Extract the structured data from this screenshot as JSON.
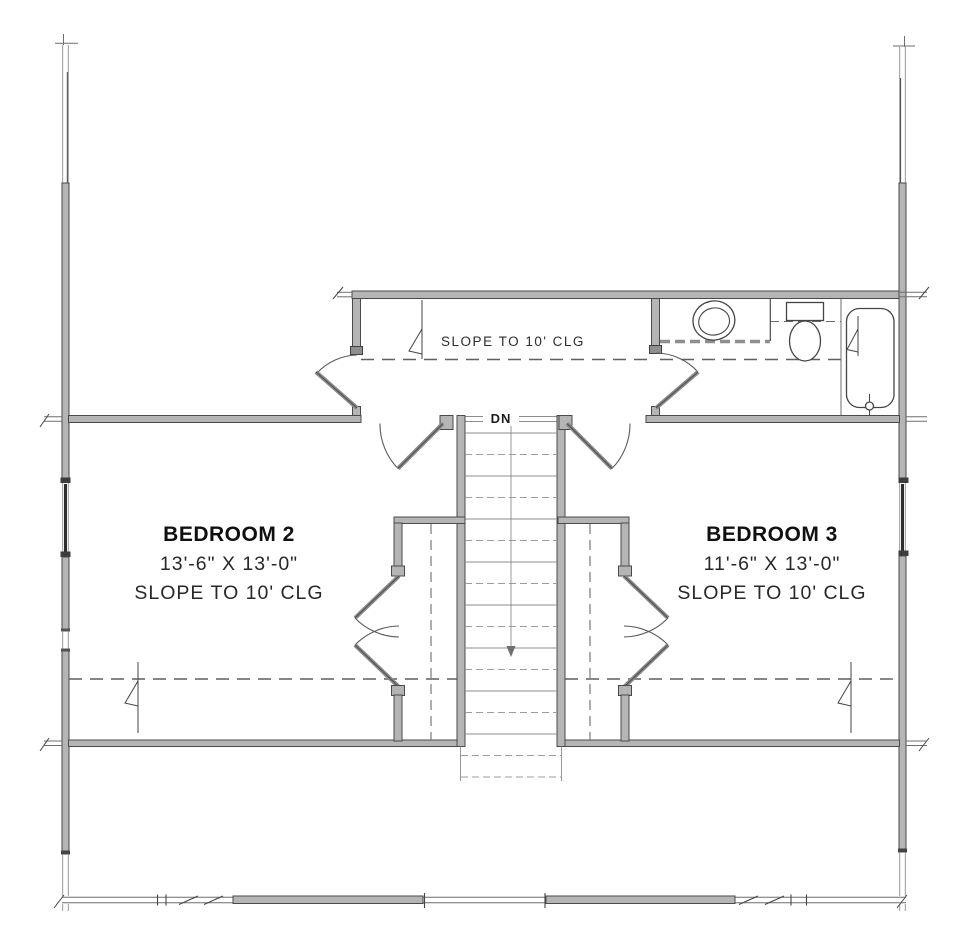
{
  "plan": {
    "hallway": {
      "ceiling_note": "SLOPE TO 10' CLG"
    },
    "stairs": {
      "direction_label": "DN"
    },
    "bedroom2": {
      "name": "BEDROOM 2",
      "dimensions": "13'-6\" X 13'-0\"",
      "ceiling_note": "SLOPE TO 10' CLG"
    },
    "bedroom3": {
      "name": "BEDROOM 3",
      "dimensions": "11'-6\" X 13'-0\"",
      "ceiling_note": "SLOPE TO 10' CLG"
    }
  },
  "colors": {
    "wall_fill": "#b5b5b5",
    "wall_edge": "#4a4a4a",
    "line": "#3f3f3f",
    "dashed_line": "#5f5f5f",
    "text": "#222222",
    "background": "#ffffff"
  }
}
